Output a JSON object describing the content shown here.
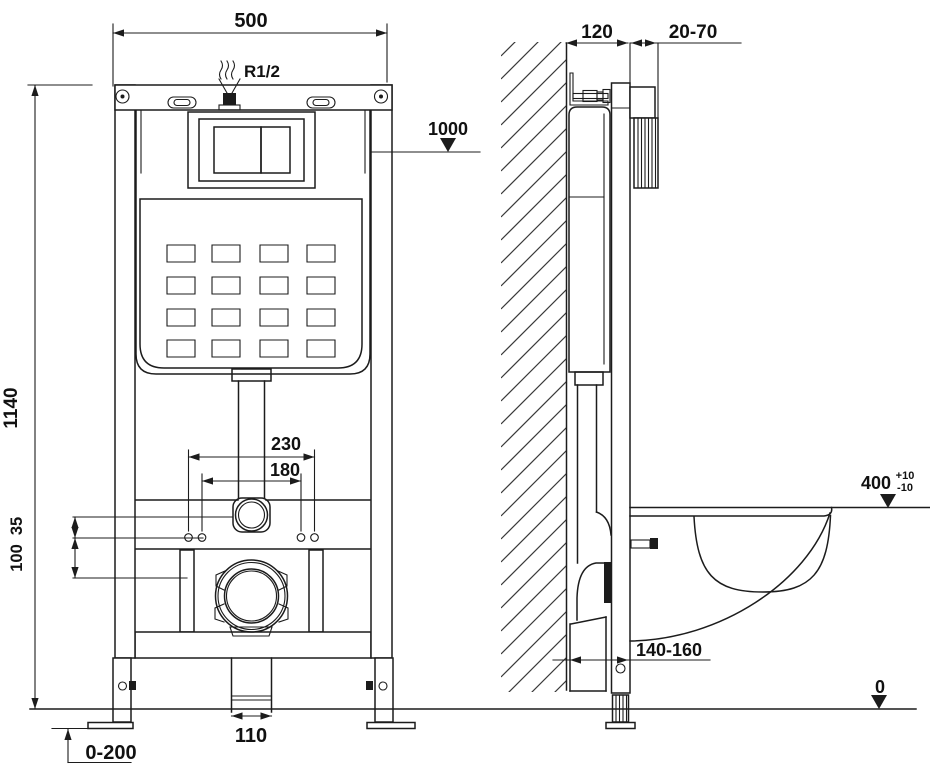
{
  "colors": {
    "line": "#1c1c1c",
    "text": "#111111",
    "background": "#ffffff"
  },
  "front_view": {
    "dimensions": {
      "frame_width": "500",
      "water_inlet": "R1/2",
      "inlet_level": "1000",
      "frame_height": "1140",
      "fixing_spacing_outer": "230",
      "fixing_spacing_inner": "180",
      "offset_upper": "35",
      "offset_lower": "100",
      "drain_outlet_width": "110",
      "leg_adjustment": "0-200"
    }
  },
  "side_view": {
    "dimensions": {
      "frame_depth": "120",
      "wall_finish_range": "20-70",
      "bowl_height": "400",
      "bowl_height_tol_plus": "+10",
      "bowl_height_tol_minus": "-10",
      "outlet_distance": "140-160",
      "floor_level": "0"
    }
  }
}
